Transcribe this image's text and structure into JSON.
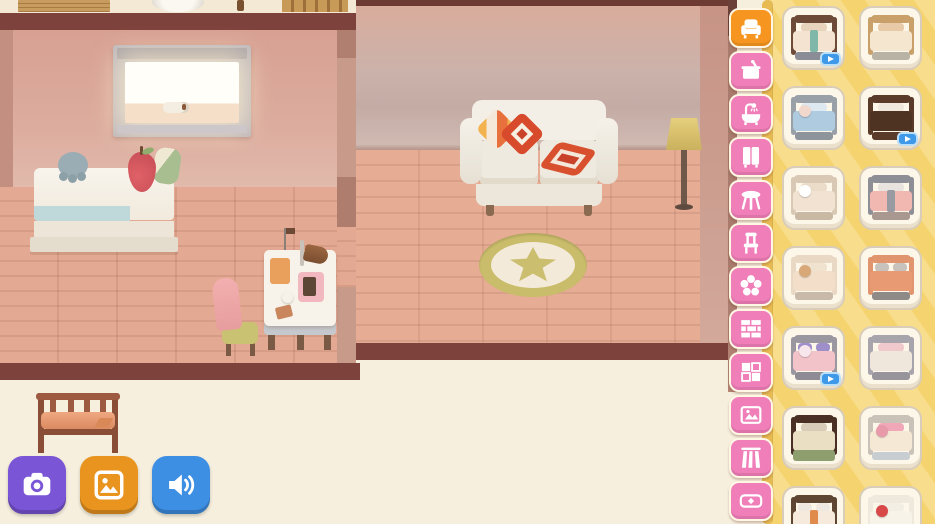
{
  "app": {
    "type": "home-decorating-game-screen"
  },
  "palette": {
    "selected_tab_orange": "#F6951F",
    "tab_pink": "#F07EB8",
    "panel_yellow": "#F5D36E",
    "panel_stripe": "#F8DE8C",
    "panel_edge_gold": "#E8BB52",
    "card_bg": "#FDF7E9",
    "card_border": "#D9CCB9",
    "video_badge_blue": "#3E9AE8",
    "beam_brown": "#7E423C",
    "left_wall_pink": "#D8A193",
    "right_wall_gray": "#C9B0A8",
    "floor_pink": "#E2A78F",
    "exterior_cream": "#F6EFDE"
  },
  "sidebar": {
    "tabs": [
      {
        "id": "furniture",
        "icon": "armchair",
        "selected": true
      },
      {
        "id": "kitchen",
        "icon": "pot",
        "selected": false
      },
      {
        "id": "bathroom",
        "icon": "bathtub",
        "selected": false
      },
      {
        "id": "wardrobe",
        "icon": "wardrobe",
        "selected": false
      },
      {
        "id": "tables",
        "icon": "table",
        "selected": false
      },
      {
        "id": "chairs",
        "icon": "chair",
        "selected": false
      },
      {
        "id": "decor",
        "icon": "flower",
        "selected": false
      },
      {
        "id": "wallpaper",
        "icon": "brick-wall",
        "selected": false
      },
      {
        "id": "tiles",
        "icon": "tiles",
        "selected": false
      },
      {
        "id": "paintings",
        "icon": "painting",
        "selected": false
      },
      {
        "id": "flooring",
        "icon": "floor-planks",
        "selected": false
      },
      {
        "id": "rugs",
        "icon": "rug",
        "selected": false
      }
    ]
  },
  "panel": {
    "category": "beds",
    "items": [
      {
        "name": "striped-ribbon-bed",
        "video_badge": true,
        "colors": {
          "frame": "#6E4A38",
          "bed": "#F3E3D0",
          "pillow": "#E8D3BD",
          "base": "#8A8D95",
          "accent": "#7FB8A8"
        }
      },
      {
        "name": "light-wood-bed",
        "video_badge": false,
        "colors": {
          "frame": "#C9A06A",
          "bed": "#F5E6CF",
          "pillow": "#E8C9A8",
          "base": "#B9B3A6"
        }
      },
      {
        "name": "blue-striped-bed",
        "video_badge": false,
        "colors": {
          "frame": "#9AA0A8",
          "bed": "#AECBE0",
          "pillow": "#DDE8F0",
          "base": "#8E949C",
          "plush": "#F0D8CC"
        }
      },
      {
        "name": "dark-wood-bed",
        "video_badge": true,
        "colors": {
          "frame": "#5A3A28",
          "bed": "#4F3322",
          "pillow": "#F0E8DC",
          "base": "#5A3A28"
        }
      },
      {
        "name": "sheep-plush-bed",
        "video_badge": false,
        "colors": {
          "frame": "#D9C9B4",
          "bed": "#F2E2D2",
          "pillow": "#EADCC8",
          "base": "#C9B9A4",
          "plush": "#FFFFFF"
        }
      },
      {
        "name": "pink-blanket-bed",
        "video_badge": false,
        "colors": {
          "frame": "#8E8E96",
          "bed": "#F0B8B0",
          "pillow": "#E8E3DE",
          "base": "#A89890",
          "accent": "#9A9AA2"
        }
      },
      {
        "name": "teddy-bear-bed",
        "video_badge": false,
        "colors": {
          "frame": "#E8D8C4",
          "bed": "#F2DEC9",
          "pillow": "#EFE2CE",
          "base": "#C9B9A8",
          "plush": "#D9A878"
        }
      },
      {
        "name": "terracotta-double-bed",
        "video_badge": false,
        "colors": {
          "frame": "#E0956E",
          "bed": "#E89A72",
          "pillow": "#C8C2BC",
          "base": "#8E8A88",
          "pillows": 2
        }
      },
      {
        "name": "floral-double-bed",
        "video_badge": true,
        "colors": {
          "frame": "#9A97A0",
          "bed": "#F2C4C9",
          "pillow": "#9E8EC9",
          "base": "#8E8B94",
          "pillows": 2,
          "plush": "#F7E7EC"
        }
      },
      {
        "name": "simple-single-bed",
        "video_badge": false,
        "colors": {
          "frame": "#A8A4AC",
          "bed": "#EFE6DC",
          "pillow": "#EFC9CC",
          "base": "#98949C"
        }
      },
      {
        "name": "bunk-bed",
        "video_badge": false,
        "colors": {
          "frame": "#4A3024",
          "bed": "#EADFC2",
          "pillow": "#D8CCB8",
          "bed2": "#8F9E6E"
        }
      },
      {
        "name": "pink-cushion-bed",
        "video_badge": false,
        "colors": {
          "frame": "#C9C2B8",
          "bed": "#F5E8D4",
          "pillow": "#F0A8B8",
          "base": "#C8CDD2",
          "plush": "#E89AAB"
        }
      },
      {
        "name": "dark-frame-double-bed",
        "video_badge": false,
        "colors": {
          "frame": "#5E4632",
          "bed": "#F5EADC",
          "pillow": "#EFE8E0",
          "base": "#C9BCA8",
          "pillows": 2,
          "accent": "#E08A4C"
        }
      },
      {
        "name": "heart-pillow-bed",
        "video_badge": false,
        "colors": {
          "frame": "#EFE9DD",
          "bed": "#F8F3E9",
          "pillow": "#F3EEE4",
          "plush": "#D84848"
        }
      }
    ]
  },
  "actions": [
    {
      "id": "camera",
      "icon": "camera",
      "color": "#7A55D6"
    },
    {
      "id": "gallery",
      "icon": "gallery",
      "color": "#E9941F"
    },
    {
      "id": "sound",
      "icon": "speaker",
      "color": "#3D8FE3"
    }
  ],
  "badge_icon": "play-icon",
  "rooms": {
    "left_room": {
      "objects": [
        "window",
        "paper-roll",
        "bed",
        "gray-paw-plush",
        "pear-plush",
        "green-pillow",
        "desk",
        "desk-lamp",
        "chair"
      ]
    },
    "right_room": {
      "objects": [
        "sofa",
        "patchwork-pillow",
        "red-diamond-pillow",
        "red-flat-pillow",
        "floor-lamp",
        "star-rug"
      ]
    },
    "outside": {
      "objects": [
        "wooden-bench"
      ]
    },
    "upper_floor": {
      "objects": [
        "wooden-crate",
        "yarn-ball",
        "wooden-stick",
        "wood-structure"
      ]
    }
  }
}
